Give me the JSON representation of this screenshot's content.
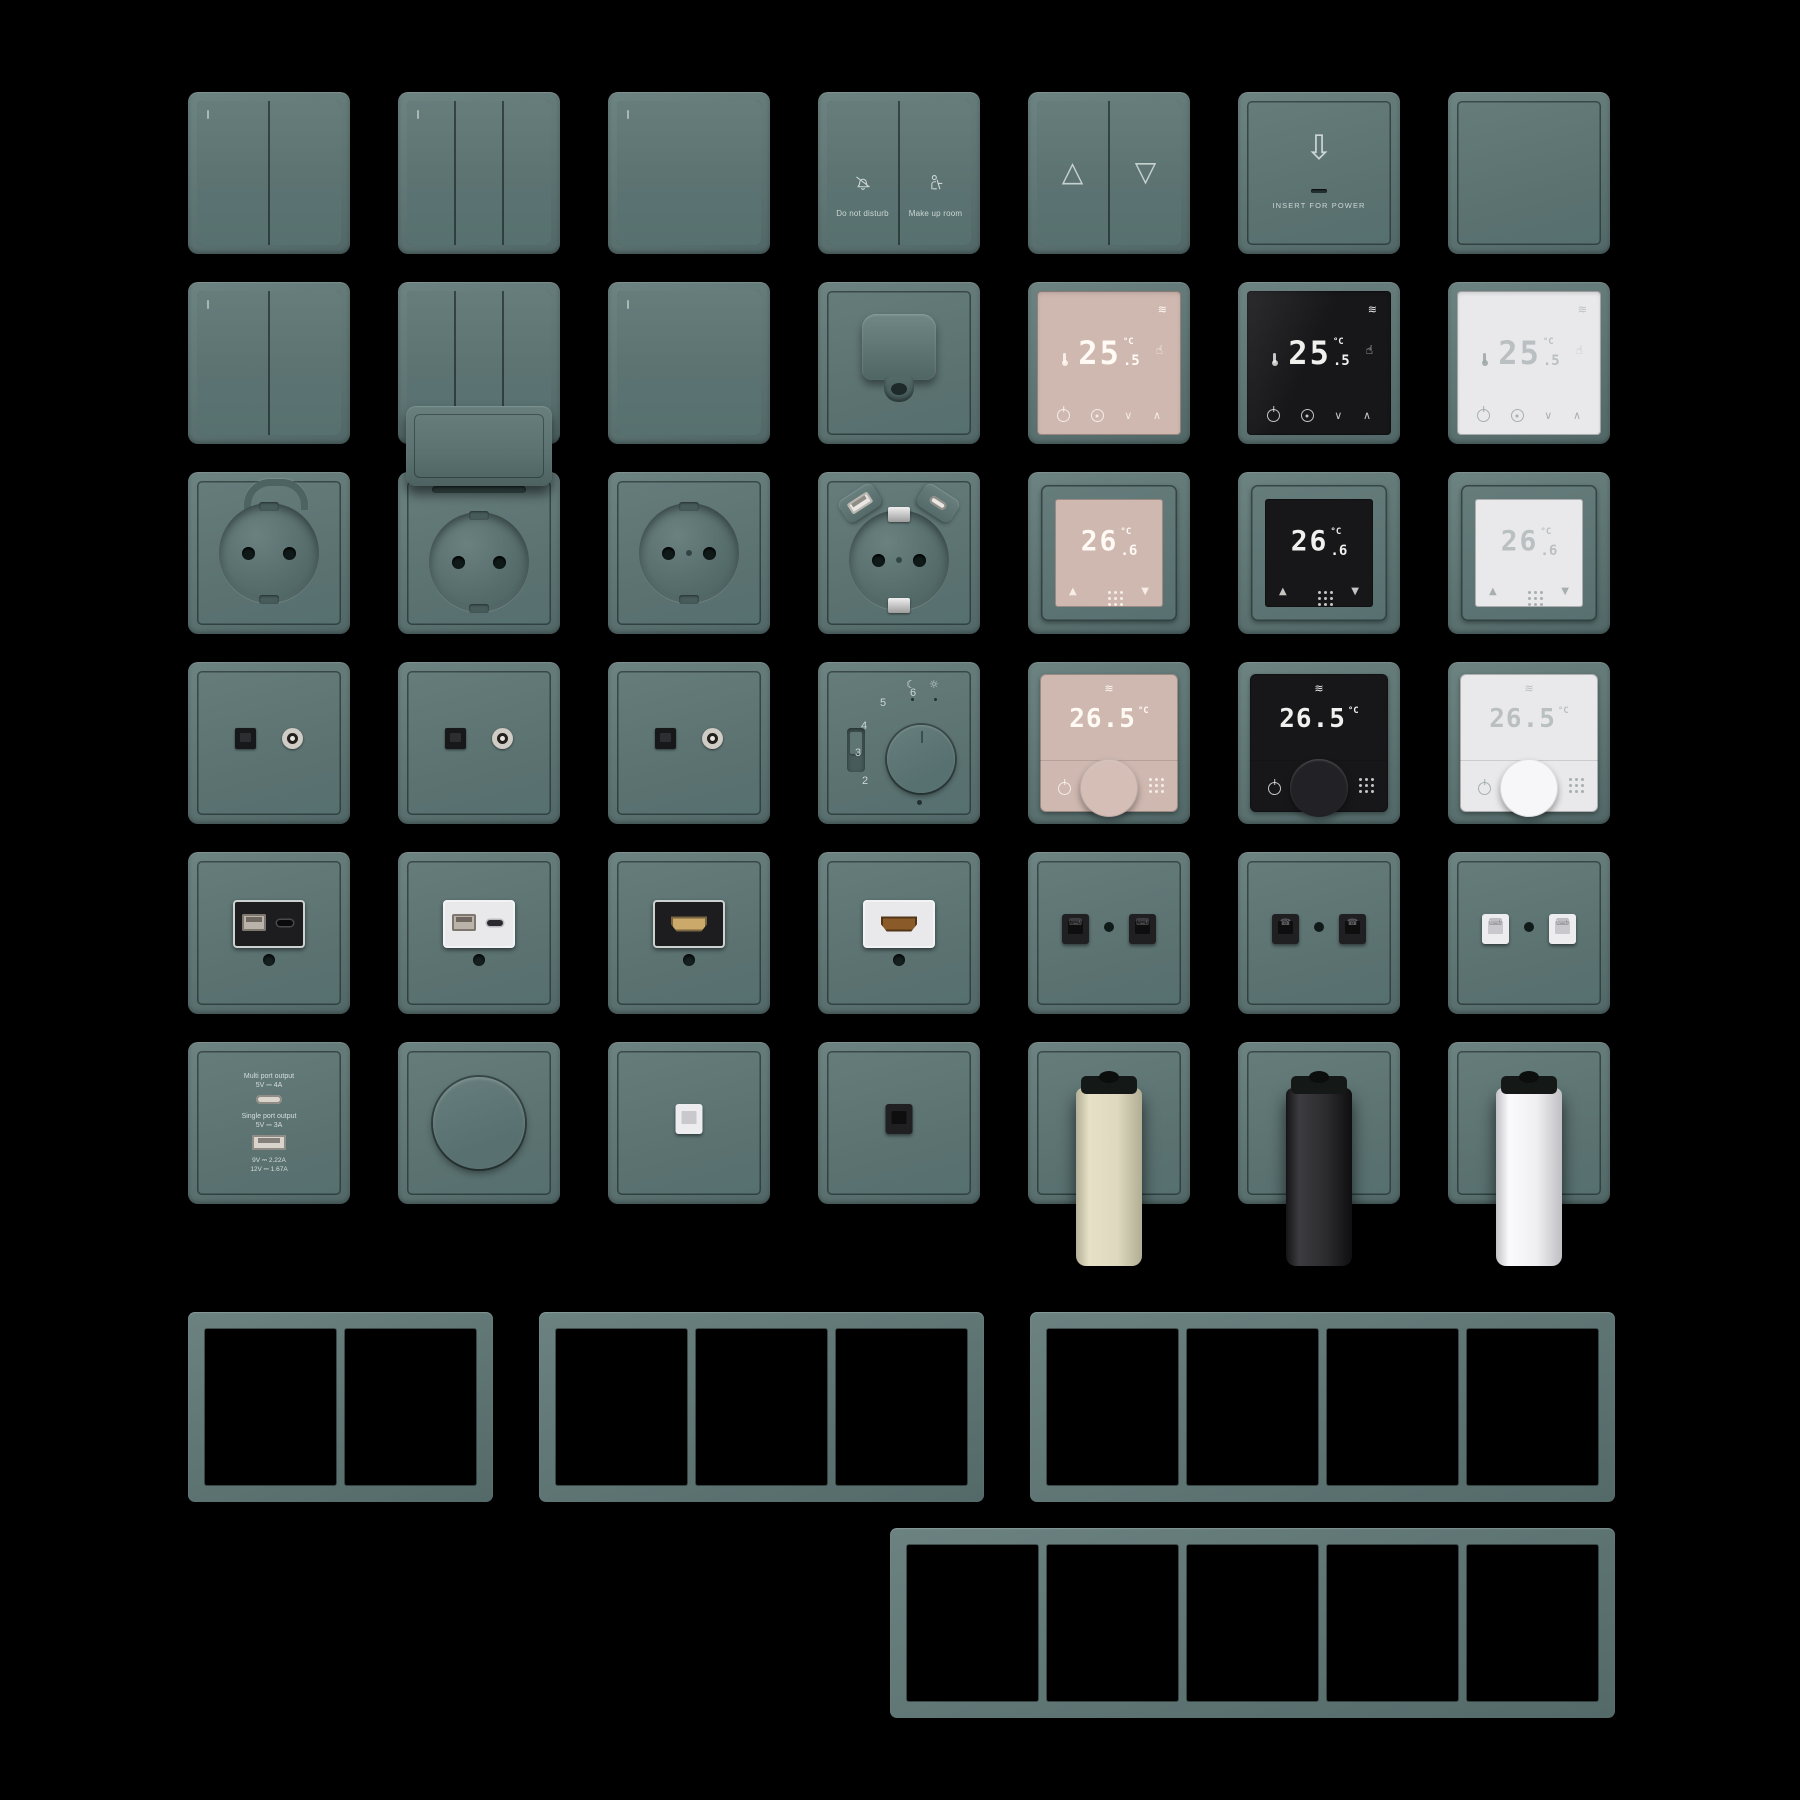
{
  "scene": {
    "background": "#000000",
    "description": "Product grid of teal wall switches, sockets, thermostats, media outlets and mounting frames on black"
  },
  "palette": {
    "plate_teal": "#5d7473",
    "plate_highlight": "#6c8382",
    "plate_shadow": "#526868",
    "seam": "#16211f",
    "screen_pink": "#cfb8b0",
    "screen_black": "#17171a",
    "screen_white": "#e9e9eb",
    "digit_light": "#fffaf4",
    "digit_gray": "#bac0c2",
    "cylinder_cream": "#ded9bf",
    "cylinder_black": "#2b2b2e",
    "cylinder_white": "#efeff2",
    "hdmi_gold": "#caa96a",
    "module_black": "#1d1d1f",
    "module_white": "#e9e9eb"
  },
  "icons": {
    "blinds_up": "△",
    "blinds_down": "▽",
    "card_arrow": "⇩",
    "heat": "≋",
    "touch_hand": "☝",
    "moon": "☾",
    "sun": "☼",
    "phone": "☎",
    "computer": "⌧",
    "arrow_up": "▲",
    "arrow_down": "▼",
    "chevron_up": "∧",
    "chevron_down": "∨"
  },
  "tiles": {
    "hotel_switch": {
      "left_label": "Do not disturb",
      "right_label": "Make up room"
    },
    "card_holder": {
      "label": "INSERT FOR POWER"
    },
    "thermostat_touch": {
      "temp_main": "25",
      "temp_dec": ".5",
      "unit": "°C"
    },
    "thermostat_square": {
      "temp_main": "26",
      "temp_dec": ".6",
      "unit": "°C"
    },
    "thermostat_knob": {
      "temp": "26.5",
      "unit": "°C"
    },
    "dial_thermostat": {
      "scale": [
        "2",
        "3",
        "4",
        "5",
        "6"
      ]
    },
    "usb_charger": {
      "multi_title": "Multi port output",
      "multi_spec": "5V ⎓ 4A",
      "single_title": "Single port output",
      "single_spec": "5V ⎓ 3A",
      "alt_spec_1": "9V ⎓ 2.22A",
      "alt_spec_2": "12V ⎓ 1.67A"
    }
  },
  "frames": {
    "gangs": [
      2,
      3,
      4,
      5
    ]
  }
}
